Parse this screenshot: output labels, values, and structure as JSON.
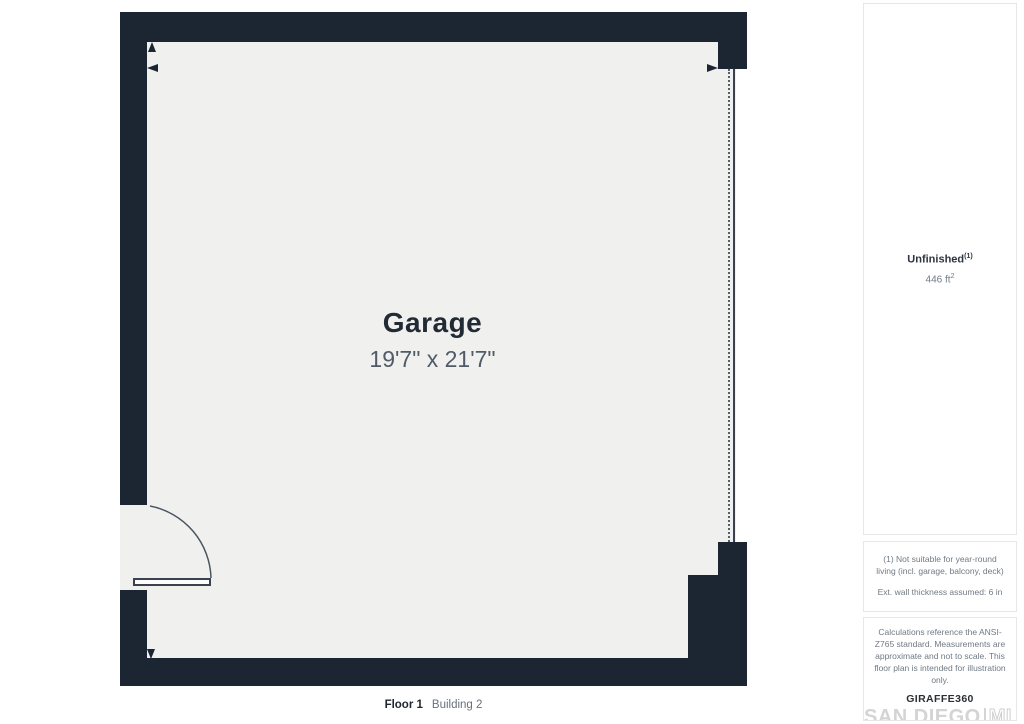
{
  "plan": {
    "room": {
      "name": "Garage",
      "dimensions": "19'7\" x 21'7\""
    },
    "floor_label": "Floor 1",
    "building_label": "Building 2"
  },
  "sidebar": {
    "area_summary": {
      "label": "Unfinished",
      "footnote_ref": "(1)",
      "area_value": "446 ft",
      "area_unit_sup": "2"
    },
    "notes": {
      "suitability": "(1) Not suitable for year-round living (incl. garage, balcony, deck)",
      "wall_thickness": "Ext. wall thickness assumed: 6 in"
    },
    "disclaimer": "Calculations reference the ANSI-Z765 standard. Measurements are approximate and not to scale. This floor plan is intended for illustration only.",
    "branding": {
      "giraffe": "GIRAFFE",
      "giraffe_suffix": "360",
      "mls_name": "SAN DIEGO",
      "mls_suffix": "MLS"
    }
  },
  "colors": {
    "wall": "#1c2532",
    "floor": "#f0f1ef",
    "room_text": "#222a35",
    "muted_text": "#707a84",
    "watermark": "#d4d4d4"
  }
}
